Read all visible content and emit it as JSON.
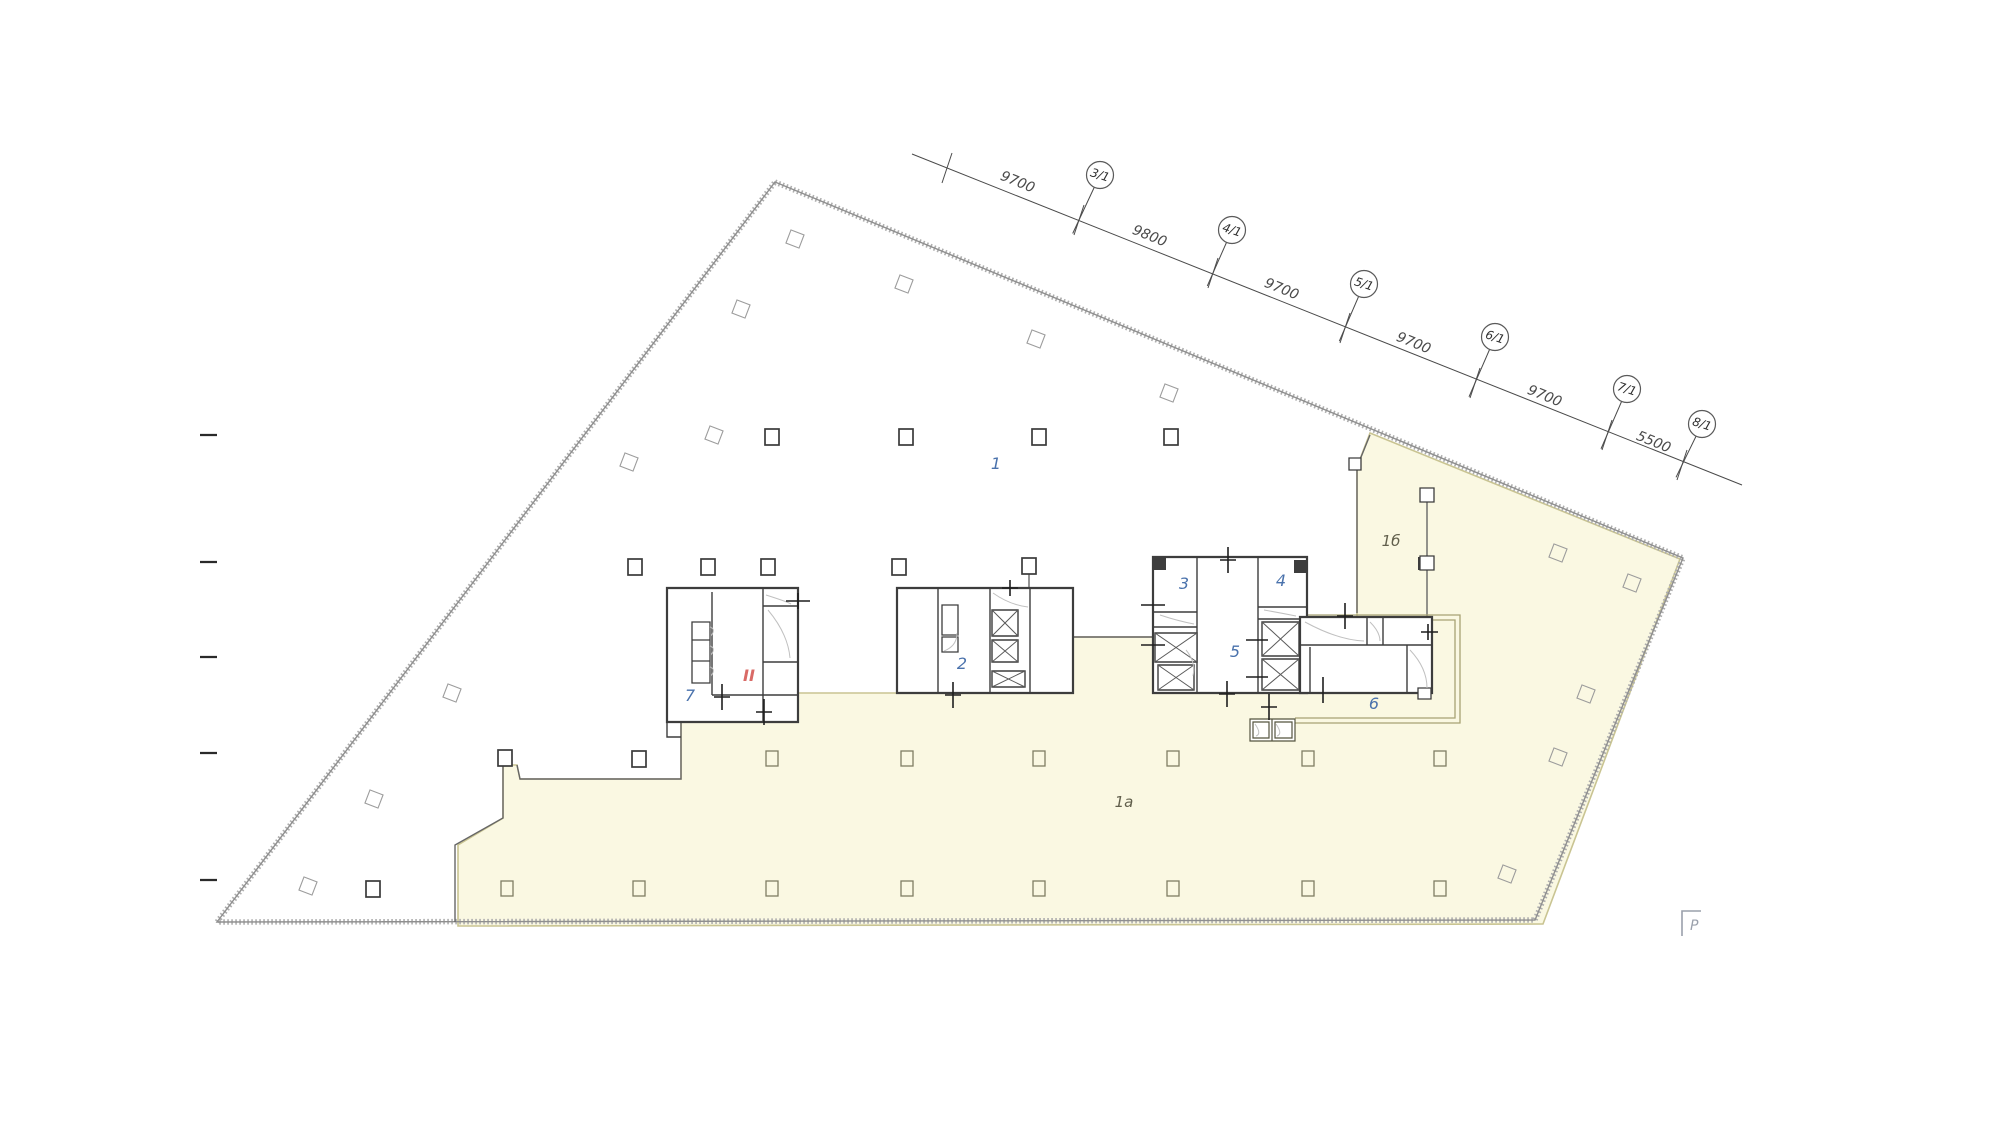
{
  "canvas": {
    "width": 1993,
    "height": 1121,
    "background": "#ffffff"
  },
  "palette": {
    "zone_fill": "#faf8e2",
    "zone_edge": "#c9c492",
    "outline_hatch": "#aeaeae",
    "outline_line": "#8f8f8f",
    "wall": "#3d3d3d",
    "thin_wall": "#666666",
    "light_line": "#c0c0c0",
    "dim_color": "#4a4a4a",
    "room_number_color": "#4a72ac",
    "zone_label_color": "#615f4c",
    "stair_label_color": "#d96a66",
    "corridor_olive": "#a8a274",
    "box_olive": "#55543f",
    "column_olive": "#7f7d63",
    "diamond_gray": "#9c9c9c",
    "tick_color": "#1f1f1f",
    "marker_gray": "#9aa0ab"
  },
  "dimension_line": {
    "start": {
      "x": 912,
      "y": 154
    },
    "end": {
      "x": 1742,
      "y": 485
    },
    "segments": [
      {
        "label": "9700",
        "lx": 1016,
        "ly": 186,
        "angle": 22.3
      },
      {
        "label": "9800",
        "lx": 1148,
        "ly": 240,
        "angle": 22.3
      },
      {
        "label": "9700",
        "lx": 1280,
        "ly": 293,
        "angle": 22.3
      },
      {
        "label": "9700",
        "lx": 1412,
        "ly": 347,
        "angle": 22.3
      },
      {
        "label": "9700",
        "lx": 1543,
        "ly": 400,
        "angle": 22.3
      },
      {
        "label": "5500",
        "lx": 1652,
        "ly": 446,
        "angle": 22.3
      }
    ],
    "stations": [
      {
        "x": 947,
        "y": 168
      },
      {
        "x": 1079,
        "y": 220
      },
      {
        "x": 1213,
        "y": 273
      },
      {
        "x": 1345,
        "y": 328
      },
      {
        "x": 1475,
        "y": 383
      },
      {
        "x": 1607,
        "y": 435
      },
      {
        "x": 1682,
        "y": 465
      }
    ],
    "axis_bubbles": [
      {
        "label": "3/1",
        "x": 1100,
        "y": 175,
        "sx": 1079,
        "sy": 220
      },
      {
        "label": "4/1",
        "x": 1232,
        "y": 230,
        "sx": 1213,
        "sy": 273
      },
      {
        "label": "5/1",
        "x": 1364,
        "y": 284,
        "sx": 1345,
        "sy": 328
      },
      {
        "label": "6/1",
        "x": 1495,
        "y": 337,
        "sx": 1475,
        "sy": 383
      },
      {
        "label": "7/1",
        "x": 1627,
        "y": 389,
        "sx": 1607,
        "sy": 435
      },
      {
        "label": "8/1",
        "x": 1702,
        "y": 424,
        "sx": 1682,
        "sy": 465
      }
    ],
    "bubble_radius": 13.5
  },
  "left_ruler_ticks": {
    "x1": 200,
    "x2": 217,
    "ys": [
      435,
      562,
      657,
      753,
      880
    ]
  },
  "room_numbers": [
    {
      "label": "1",
      "x": 996,
      "y": 469
    },
    {
      "label": "2",
      "x": 962,
      "y": 669
    },
    {
      "label": "3",
      "x": 1184,
      "y": 589
    },
    {
      "label": "4",
      "x": 1281,
      "y": 586
    },
    {
      "label": "5",
      "x": 1235,
      "y": 657
    },
    {
      "label": "6",
      "x": 1374,
      "y": 709
    },
    {
      "label": "7",
      "x": 690,
      "y": 701
    }
  ],
  "zone_labels": [
    {
      "label": "1а",
      "x": 1124,
      "y": 807
    },
    {
      "label": "1б",
      "x": 1391,
      "y": 546
    }
  ],
  "stair_label": {
    "label": "II",
    "x": 749,
    "y": 681
  },
  "columns": {
    "square_dark": [
      [
        772,
        437
      ],
      [
        906,
        437
      ],
      [
        1039,
        437
      ],
      [
        1171,
        437
      ],
      [
        635,
        567
      ],
      [
        708,
        567
      ],
      [
        768,
        567
      ],
      [
        899,
        567
      ],
      [
        373,
        889
      ],
      [
        505,
        758
      ],
      [
        639,
        759
      ],
      [
        1029,
        566
      ]
    ],
    "square_olive": [
      [
        772,
        759
      ],
      [
        907,
        759
      ],
      [
        1039,
        759
      ],
      [
        1173,
        759
      ],
      [
        1308,
        759
      ],
      [
        1440,
        759
      ],
      [
        507,
        889
      ],
      [
        639,
        889
      ],
      [
        772,
        889
      ],
      [
        907,
        889
      ],
      [
        1039,
        889
      ],
      [
        1173,
        889
      ],
      [
        1308,
        889
      ],
      [
        1440,
        889
      ]
    ],
    "diamond": [
      [
        795,
        239
      ],
      [
        904,
        284
      ],
      [
        741,
        309
      ],
      [
        1036,
        339
      ],
      [
        1169,
        393
      ],
      [
        714,
        435
      ],
      [
        629,
        462
      ],
      [
        452,
        693
      ],
      [
        374,
        799
      ],
      [
        308,
        886
      ],
      [
        1558,
        553
      ],
      [
        1632,
        583
      ],
      [
        1586,
        694
      ],
      [
        1558,
        757
      ],
      [
        1507,
        874
      ]
    ],
    "diamond_angle": 21
  },
  "page_marker": {
    "label": "Р",
    "x": 1690,
    "y": 930
  }
}
